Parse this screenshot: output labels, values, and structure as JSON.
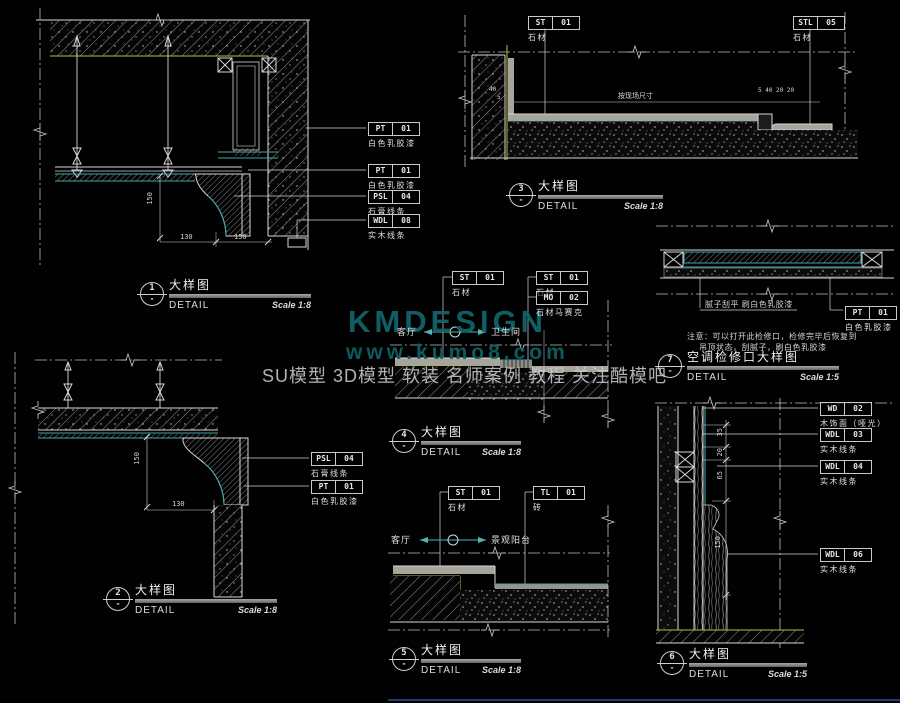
{
  "watermark": {
    "brand": "KMDESIGN",
    "url": "www.kumo8.com",
    "tagline": "SU模型 3D模型 软装 名师案例 教程 关注酷模吧"
  },
  "details": [
    {
      "num": "1",
      "ref": "-",
      "title": "大样图",
      "subtitle": "DETAIL",
      "scale": "Scale 1:8"
    },
    {
      "num": "2",
      "ref": "-",
      "title": "大样图",
      "subtitle": "DETAIL",
      "scale": "Scale 1:8"
    },
    {
      "num": "3",
      "ref": "-",
      "title": "大样图",
      "subtitle": "DETAIL",
      "scale": "Scale 1:8"
    },
    {
      "num": "4",
      "ref": "-",
      "title": "大样图",
      "subtitle": "DETAIL",
      "scale": "Scale 1:8"
    },
    {
      "num": "5",
      "ref": "-",
      "title": "大样图",
      "subtitle": "DETAIL",
      "scale": "Scale 1:8"
    },
    {
      "num": "6",
      "ref": "-",
      "title": "大样图",
      "subtitle": "DETAIL",
      "scale": "Scale 1:5"
    },
    {
      "num": "7",
      "ref": "-",
      "title": "空调检修口大样图",
      "subtitle": "DETAIL",
      "scale": "Scale 1:5"
    }
  ],
  "tags": [
    {
      "code": "PT",
      "num": "01",
      "desc": "白色乳胶漆"
    },
    {
      "code": "PT",
      "num": "01",
      "desc": "白色乳胶漆"
    },
    {
      "code": "PSL",
      "num": "04",
      "desc": "石膏线条"
    },
    {
      "code": "WDL",
      "num": "08",
      "desc": "实木线条"
    },
    {
      "code": "ST",
      "num": "01",
      "desc": "石材"
    },
    {
      "code": "STL",
      "num": "05",
      "desc": "石材"
    },
    {
      "code": "ST",
      "num": "01",
      "desc": "石材"
    },
    {
      "code": "ST",
      "num": "01",
      "desc": "石材"
    },
    {
      "code": "MO",
      "num": "02",
      "desc": "石材马赛克"
    },
    {
      "code": "PSL",
      "num": "04",
      "desc": "石膏线条"
    },
    {
      "code": "PT",
      "num": "01",
      "desc": "白色乳胶漆"
    },
    {
      "code": "ST",
      "num": "01",
      "desc": "石材"
    },
    {
      "code": "TL",
      "num": "01",
      "desc": "砖"
    },
    {
      "code": "WD",
      "num": "02",
      "desc": "木饰面（哑光）"
    },
    {
      "code": "WDL",
      "num": "03",
      "desc": "实木线条"
    },
    {
      "code": "WDL",
      "num": "04",
      "desc": "实木线条"
    },
    {
      "code": "WDL",
      "num": "06",
      "desc": "实木线条"
    },
    {
      "code": "PT",
      "num": "01",
      "desc": "白色乳胶漆"
    }
  ],
  "dims": {
    "d1_v": "150",
    "d1_h1": "130",
    "d1_h2": "150",
    "d2_v": "150",
    "d2_h": "130",
    "d3_left_a": "40",
    "d3_left_b": "5",
    "d3_mid": "按现场尺寸",
    "d3_right": "5 40 20 20",
    "d6_a": "35",
    "d6_b": "20",
    "d6_c": "65",
    "d6_d": "150"
  },
  "labels": {
    "d4_left": "客厅",
    "d4_right": "卫生间",
    "d5_left": "客厅",
    "d5_right": "景观阳台",
    "d7_putty": "腻子刮平 刷白色乳胶漆",
    "d7_note1": "注意：可以打开此检修口，检修完毕后恢复到",
    "d7_note2": "吊顶状态，刮腻子，刷白色乳胶漆"
  },
  "colors": {
    "background": "#010101",
    "line": "#d6d6d6",
    "teal": "#3fa8a8",
    "yellow": "#b9b94a",
    "stone_gray": "#a7a49c",
    "watermark_teal": "#116368",
    "border_blue": "#31519e"
  }
}
